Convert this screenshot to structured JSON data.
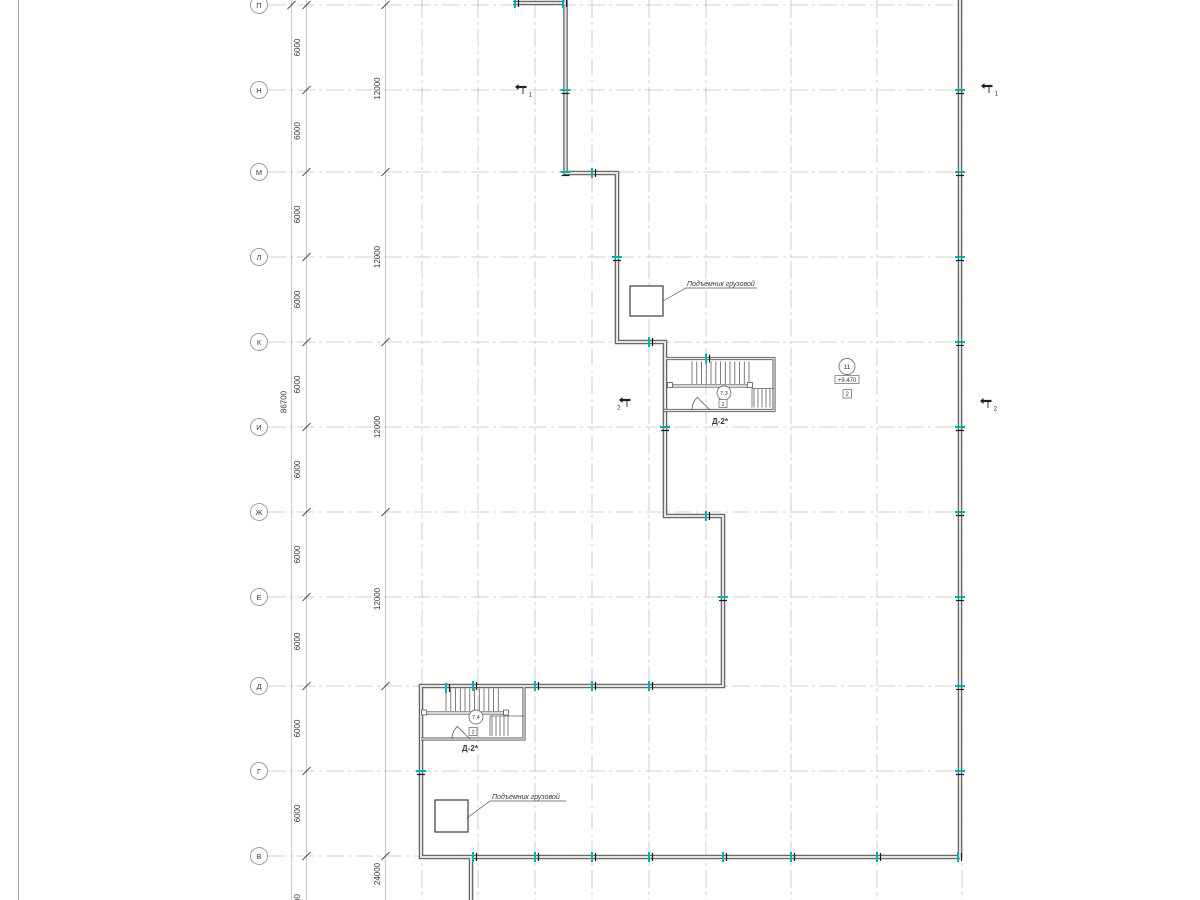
{
  "grid": {
    "rows": [
      "П",
      "Н",
      "М",
      "Л",
      "К",
      "И",
      "Ж",
      "Е",
      "Д",
      "Г",
      "В"
    ],
    "row_dim_label": "6000",
    "span_dims": [
      "12000",
      "12000",
      "12000",
      "12000"
    ],
    "total_dim": "86700",
    "below_dim": "24000",
    "partial_dim": "6000"
  },
  "stairs": {
    "upper": {
      "room_circle": "7.3",
      "door_square": "2",
      "label": "Д-2*"
    },
    "lower": {
      "room_circle": "7.4",
      "door_square": "2",
      "label": "Д-2*"
    }
  },
  "lifts": {
    "label": "Подъемник грузовой"
  },
  "level_tag": {
    "position": "11",
    "elevation": "+9.470",
    "mark": "2"
  },
  "sections": {
    "s1": "1",
    "s2": "2"
  },
  "colors": {
    "teal": "#00b0b5",
    "wall": "#6a6a6a",
    "grid": "#bdbdbd",
    "text": "#3a3a3a"
  }
}
